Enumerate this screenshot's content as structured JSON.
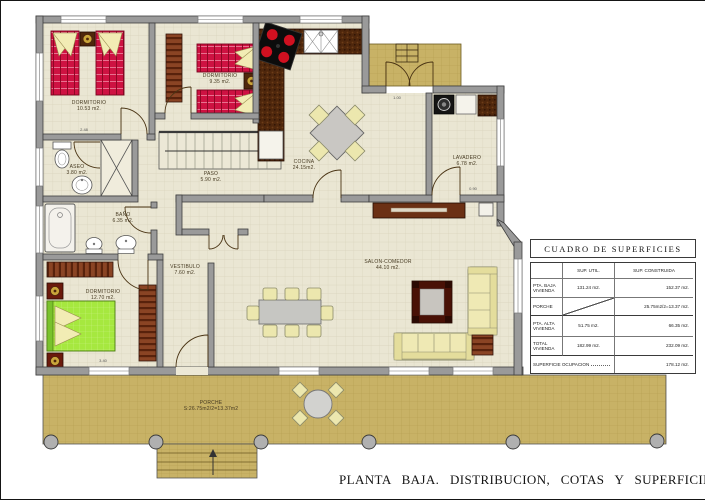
{
  "title": "PLANTA BAJA. DISTRIBUCION, COTAS Y SUPERFICIES",
  "rooms": [
    {
      "name": "DORMITORIO",
      "area": "10.53 m2."
    },
    {
      "name": "DORMITORIO",
      "area": "9.35 m2."
    },
    {
      "name": "COCINA",
      "area": "24.15m2."
    },
    {
      "name": "LAVADERO",
      "area": "6.78 m2."
    },
    {
      "name": "ASEO",
      "area": "3.80 m2."
    },
    {
      "name": "PASO",
      "area": "5.90 m2."
    },
    {
      "name": "BAÑO",
      "area": "6.35 m2."
    },
    {
      "name": "VESTIBULO",
      "area": "7.60 m2."
    },
    {
      "name": "DORMITORIO",
      "area": "12.70 m2."
    },
    {
      "name": "SALON-COMEDOR",
      "area": "44.10 m2."
    },
    {
      "name": "PORCHE",
      "area": "S:26.75m2/2=13.37m2"
    }
  ],
  "dimensions": [
    "2.48",
    "3.40",
    "1.00",
    "0.90"
  ],
  "surface_table": {
    "title": "CUADRO DE SUPERFICIES",
    "columns": [
      "",
      "SUP. UTIL.",
      "SUP. CONSTRUIDA"
    ],
    "rows": [
      {
        "label": "PTA. BAJA VIVIENDA",
        "sup_util": "131.24 m2.",
        "sup_construida": "152.37 m2."
      },
      {
        "label": "PORCHE",
        "sup_util": "",
        "sup_construida": "25.75m2/2=13.37 m2."
      },
      {
        "label": "PTA. ALTA VIVIENDA",
        "sup_util": "51.75 m2.",
        "sup_construida": "66.35 m2."
      },
      {
        "label": "TOTAL VIVIENDA",
        "sup_util": "182.99 m2.",
        "sup_construida": "232.09 m2."
      },
      {
        "label": "SUPERFICIE OCUPACION",
        "sup_util": "",
        "sup_construida": "178.12 m2."
      }
    ]
  },
  "colors": {
    "floor": "#eae6d3",
    "porch": "#c8b266",
    "wall": "#9a9a9a",
    "bed_red": "#ce1242",
    "bed_green": "#a6e83f",
    "sofa_cream": "#efe9b4",
    "counter_brown": "#4f270c"
  }
}
